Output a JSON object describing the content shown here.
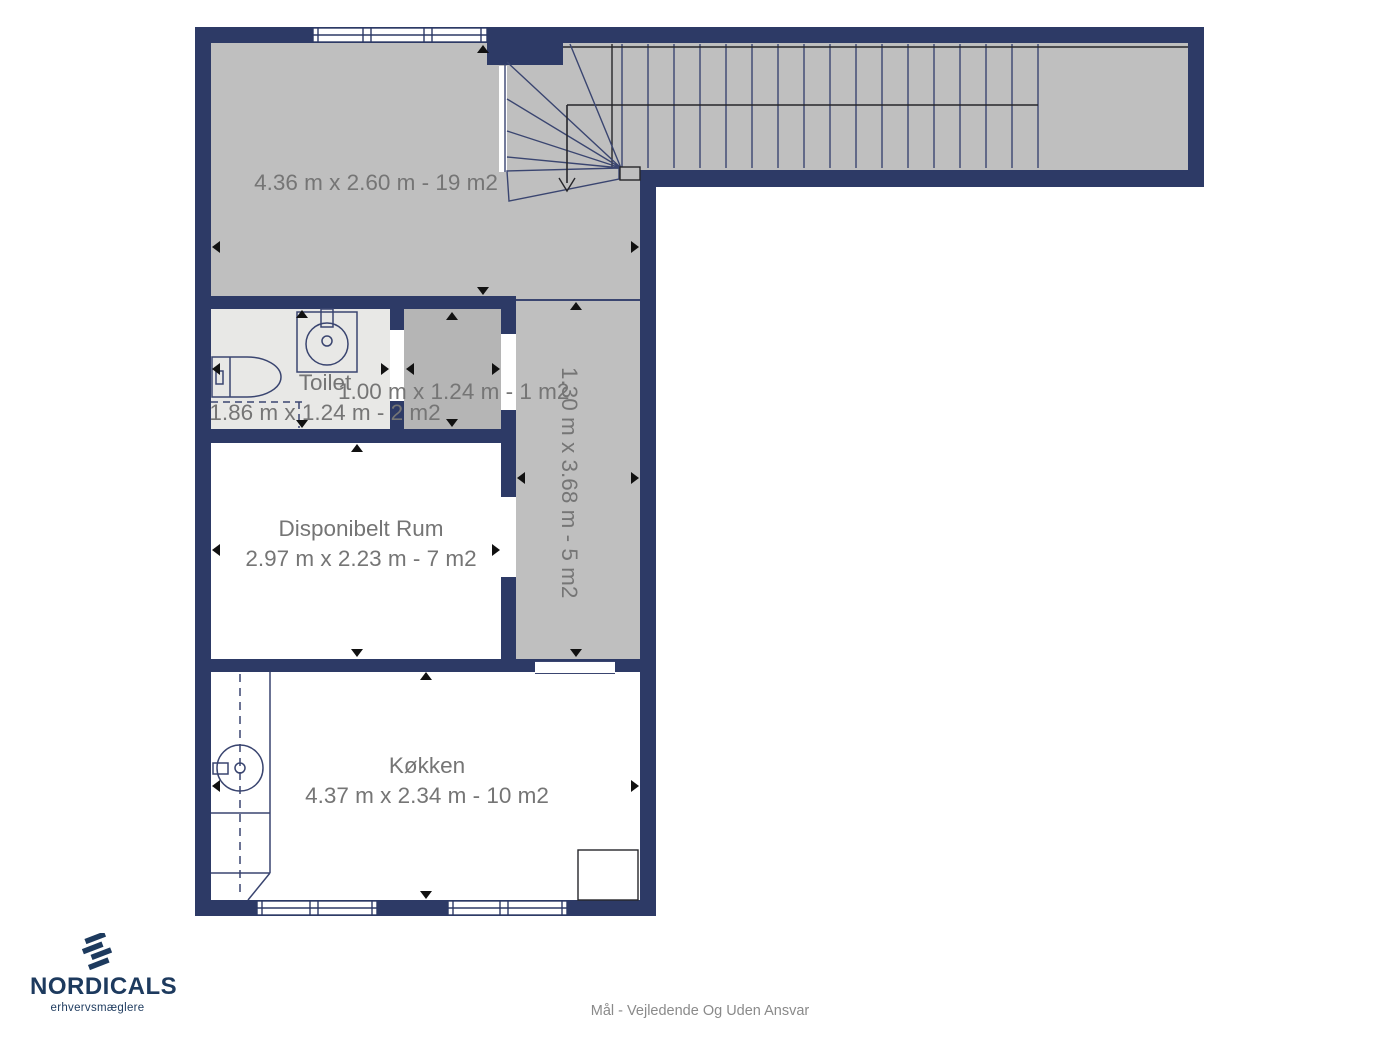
{
  "plan": {
    "rooms": {
      "main_room": {
        "dims": "4.36 m x 2.60 m - 19 m2"
      },
      "toilet": {
        "label": "Toilet",
        "dims": "1.86 m x 1.24 m - 2 m2"
      },
      "small_room": {
        "dims": "1.00 m x 1.24 m - 1 m2"
      },
      "hallway": {
        "dims": "1.30 m x 3.68 m - 5 m2"
      },
      "disponibelt_rum": {
        "label": "Disponibelt Rum",
        "dims": "2.97 m x 2.23 m - 7 m2"
      },
      "kitchen": {
        "label": "Køkken",
        "dims": "4.37 m x 2.34 m - 10 m2"
      }
    }
  },
  "branding": {
    "logo_text": "NORDICALS",
    "logo_tagline": "erhvervsmæglere"
  },
  "footer": {
    "disclaimer": "Mål - Vejledende Og Uden Ansvar"
  },
  "colors": {
    "wall": "#2d3a66",
    "floor-gray": "#bfbfbf",
    "floor-light": "#e8e8e6",
    "floor-mid": "#b5b5b5",
    "line-blue": "#3a4570",
    "line-dark": "#26262a",
    "text-gray": "#757575",
    "brand-navy": "#1d3a5e",
    "footer-gray": "#8a8a8a"
  }
}
